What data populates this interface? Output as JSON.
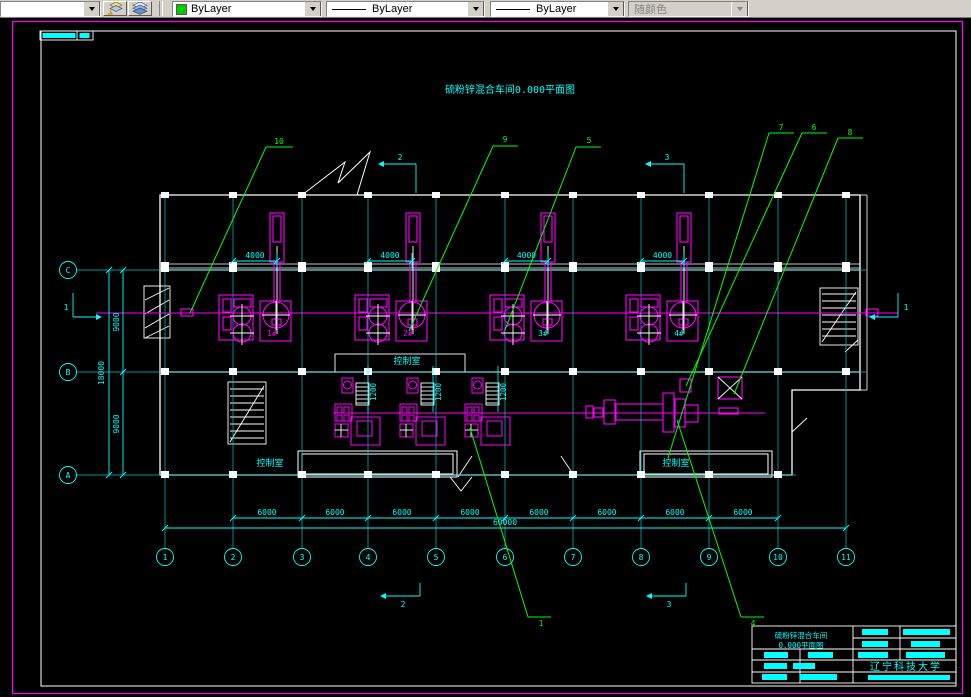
{
  "toolbar": {
    "combo_partial": {
      "value": ""
    },
    "color_combo": {
      "value": "ByLayer",
      "swatch_color": "#00cc00"
    },
    "linetype_combo_1": {
      "value": "ByLayer"
    },
    "linetype_combo_2": {
      "value": "ByLayer"
    },
    "plotstyle_combo": {
      "value": "随颜色"
    }
  },
  "drawing": {
    "title": "硫粉锌混合车间0.000平面图",
    "colors": {
      "frame": "#ff00ff",
      "sheet": "#ffffff",
      "dims": "#00ffff",
      "equipment": "#ff00ff",
      "leaders": "#00ff00"
    },
    "axes_bottom": [
      {
        "label": "1",
        "x": 165
      },
      {
        "label": "2",
        "x": 233
      },
      {
        "label": "3",
        "x": 302
      },
      {
        "label": "4",
        "x": 368
      },
      {
        "label": "5",
        "x": 436
      },
      {
        "label": "6",
        "x": 505
      },
      {
        "label": "7",
        "x": 573
      },
      {
        "label": "8",
        "x": 641
      },
      {
        "label": "9",
        "x": 709
      },
      {
        "label": "10",
        "x": 778
      },
      {
        "label": "11",
        "x": 846
      }
    ],
    "axes_left": [
      {
        "label": "C",
        "y": 270,
        "x_end": 866
      },
      {
        "label": "B",
        "y": 372,
        "x_end": 866
      },
      {
        "label": "A",
        "y": 475,
        "x_end": 796
      }
    ],
    "dims_left": {
      "line_inner_x": 123,
      "line_outer_x": 109,
      "y_top": 270,
      "y_mid": 372,
      "y_bot": 475,
      "labels": [
        {
          "text": "9000",
          "x": 119,
          "y": 322
        },
        {
          "text": "9000",
          "x": 119,
          "y": 424
        },
        {
          "text": "18000",
          "x": 104,
          "y": 373
        }
      ]
    },
    "dims_4000": {
      "label": "4000",
      "y": 261,
      "pairs": [
        [
          233,
          277
        ],
        [
          368,
          412
        ],
        [
          505,
          548
        ],
        [
          641,
          684
        ]
      ]
    },
    "dims_6000": {
      "label": "6000",
      "y": 518,
      "x_start": 233,
      "x_end": 778,
      "label_y": 515,
      "centers": [
        267,
        335,
        402,
        470,
        539,
        607,
        675,
        743
      ]
    },
    "dim_total": {
      "label": "60000",
      "y": 528,
      "x_start": 165,
      "x_end": 846,
      "label_x": 505,
      "label_y": 525
    },
    "dims_1200": {
      "label": "1200",
      "xs": [
        376,
        441,
        506
      ],
      "y": 392
    },
    "balloons": [
      {
        "label": "10",
        "tx": 279,
        "ty": 144,
        "tick": [
          266,
          147,
          293,
          147
        ],
        "line": [
          266,
          147,
          190,
          313
        ]
      },
      {
        "label": "9",
        "tx": 505,
        "ty": 142,
        "tick": [
          493,
          146,
          518,
          146
        ],
        "line": [
          493,
          146,
          409,
          331
        ]
      },
      {
        "label": "5",
        "tx": 589,
        "ty": 143,
        "tick": [
          576,
          147,
          601,
          147
        ],
        "line": [
          576,
          147,
          505,
          330
        ]
      },
      {
        "label": "7",
        "tx": 781,
        "ty": 130,
        "tick": [
          769,
          133,
          794,
          133
        ],
        "line": [
          769,
          133,
          668,
          458
        ]
      },
      {
        "label": "6",
        "tx": 814,
        "ty": 130,
        "tick": [
          802,
          133,
          827,
          133
        ],
        "line": [
          802,
          133,
          686,
          386
        ]
      },
      {
        "label": "8",
        "tx": 850,
        "ty": 135,
        "tick": [
          838,
          138,
          863,
          138
        ],
        "line": [
          838,
          138,
          734,
          394
        ]
      },
      {
        "label": "1",
        "tx": 541,
        "ty": 626,
        "tick": [
          528,
          617,
          551,
          617
        ],
        "line": [
          528,
          617,
          470,
          428
        ]
      },
      {
        "label": "4",
        "tx": 753,
        "ty": 626,
        "tick": [
          741,
          617,
          764,
          617
        ],
        "line": [
          741,
          617,
          677,
          420
        ]
      }
    ],
    "sections": [
      {
        "label": "2",
        "tx": 400,
        "ty": 160,
        "segs": [
          [
            384,
            164,
            416,
            164
          ],
          [
            416,
            164,
            416,
            193
          ]
        ],
        "arrow": [
          384,
          164,
          "left"
        ]
      },
      {
        "label": "3",
        "tx": 667,
        "ty": 160,
        "segs": [
          [
            651,
            164,
            684,
            164
          ],
          [
            684,
            164,
            684,
            193
          ]
        ],
        "arrow": [
          651,
          164,
          "left"
        ]
      },
      {
        "label": "2",
        "tx": 403,
        "ty": 607,
        "segs": [
          [
            386,
            596,
            420,
            596
          ],
          [
            420,
            583,
            420,
            596
          ]
        ],
        "arrow": [
          386,
          596,
          "left"
        ]
      },
      {
        "label": "3",
        "tx": 669,
        "ty": 607,
        "segs": [
          [
            652,
            596,
            686,
            596
          ],
          [
            686,
            583,
            686,
            596
          ]
        ],
        "arrow": [
          652,
          596,
          "left"
        ]
      },
      {
        "label": "1",
        "tx": 66,
        "ty": 310,
        "segs": [
          [
            73,
            293,
            73,
            317
          ],
          [
            73,
            317,
            96,
            317
          ]
        ],
        "arrow": [
          96,
          317,
          "right"
        ]
      },
      {
        "label": "1",
        "tx": 906,
        "ty": 310,
        "segs": [
          [
            898,
            293,
            898,
            317
          ],
          [
            875,
            317,
            898,
            317
          ]
        ],
        "arrow": [
          875,
          317,
          "left"
        ]
      }
    ],
    "rooms": [
      {
        "label": "控制室",
        "x": 270,
        "y": 466
      },
      {
        "label": "控制室",
        "x": 407,
        "y": 364
      },
      {
        "label": "控制室",
        "x": 676,
        "y": 466
      }
    ],
    "equipment_units": [
      {
        "label": "1#",
        "x": 277,
        "label_color": "#ff00ff"
      },
      {
        "label": "2#",
        "x": 413,
        "label_color": "#ff00ff"
      },
      {
        "label": "3#",
        "x": 548,
        "label_color": "#00ffff"
      },
      {
        "label": "4#",
        "x": 684,
        "label_color": "#00ffff"
      }
    ],
    "lower_units": {
      "xs": [
        352,
        417,
        482
      ]
    },
    "titleblock": {
      "line1": "硫粉锌混合车间",
      "line2": "0.000平面图",
      "org": "辽宁科技大学"
    }
  }
}
